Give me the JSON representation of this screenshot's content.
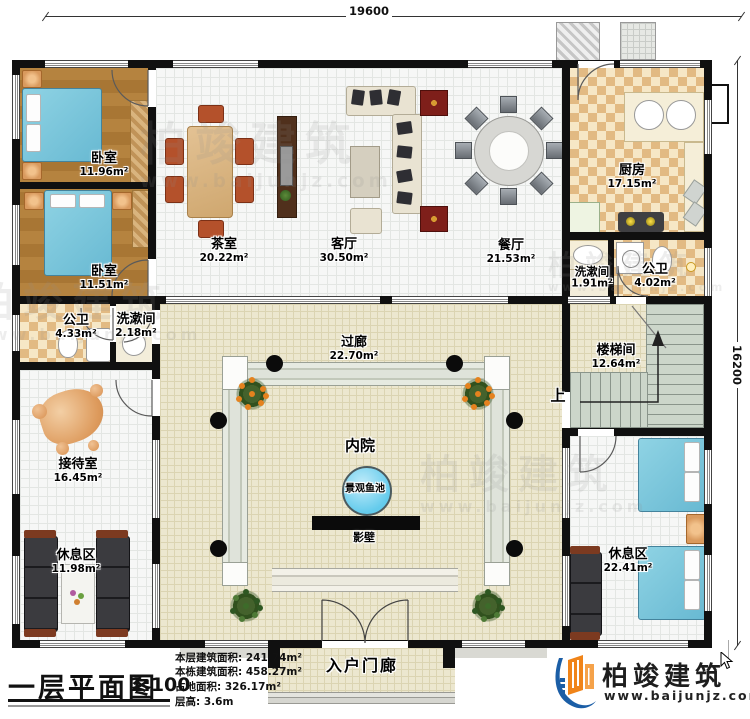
{
  "dimensions": {
    "width_mm": "19600",
    "height_mm": "16200"
  },
  "rooms": {
    "bedroom1": {
      "name": "卧室",
      "area": "11.96m²"
    },
    "bedroom2": {
      "name": "卧室",
      "area": "11.51m²"
    },
    "bath1": {
      "name": "公卫",
      "area": "4.33m²"
    },
    "wash1": {
      "name": "洗漱间",
      "area": "2.18m²"
    },
    "reception": {
      "name": "接待室",
      "area": "16.45m²"
    },
    "rest1": {
      "name": "休息区",
      "area": "11.98m²"
    },
    "tea": {
      "name": "茶室",
      "area": "20.22m²"
    },
    "living": {
      "name": "客厅",
      "area": "30.50m²"
    },
    "dining": {
      "name": "餐厅",
      "area": "21.53m²"
    },
    "kitchen": {
      "name": "厨房",
      "area": "17.15m²"
    },
    "wash2": {
      "name": "洗漱间",
      "area": "1.91m²"
    },
    "bath2": {
      "name": "公卫",
      "area": "4.02m²"
    },
    "corridor": {
      "name": "过廊",
      "area": "22.70m²"
    },
    "stairwell": {
      "name": "楼梯间",
      "area": "12.64m²"
    },
    "rest2": {
      "name": "休息区",
      "area": "22.41m²"
    },
    "courtyard": {
      "name": "内院"
    },
    "pond": {
      "name": "景观鱼池"
    },
    "screen_wall": {
      "name": "影壁"
    },
    "porch": {
      "name": "入户门廊"
    }
  },
  "stair_direction": "上",
  "title_block": {
    "title": "一层平面图",
    "scale": "1:100",
    "stats": [
      {
        "label": "本层建筑面积:",
        "value": "241.74m²"
      },
      {
        "label": "本栋建筑面积:",
        "value": "458.27m²"
      },
      {
        "label": "占地面积:",
        "value": "326.17m²"
      },
      {
        "label": "层高:",
        "value": "3.6m"
      }
    ]
  },
  "brand": {
    "name": "柏竣建筑",
    "website": "www.baijunjz.com"
  },
  "watermark": {
    "text": "柏竣建筑",
    "website": "www.baijunjz.com"
  },
  "colors": {
    "wall": "#101010",
    "logo_blue": "#1b5ea6",
    "logo_orange": "#f08419",
    "pond_blue": "#7fd4f0",
    "bed_blue": "#8fd3e4"
  }
}
